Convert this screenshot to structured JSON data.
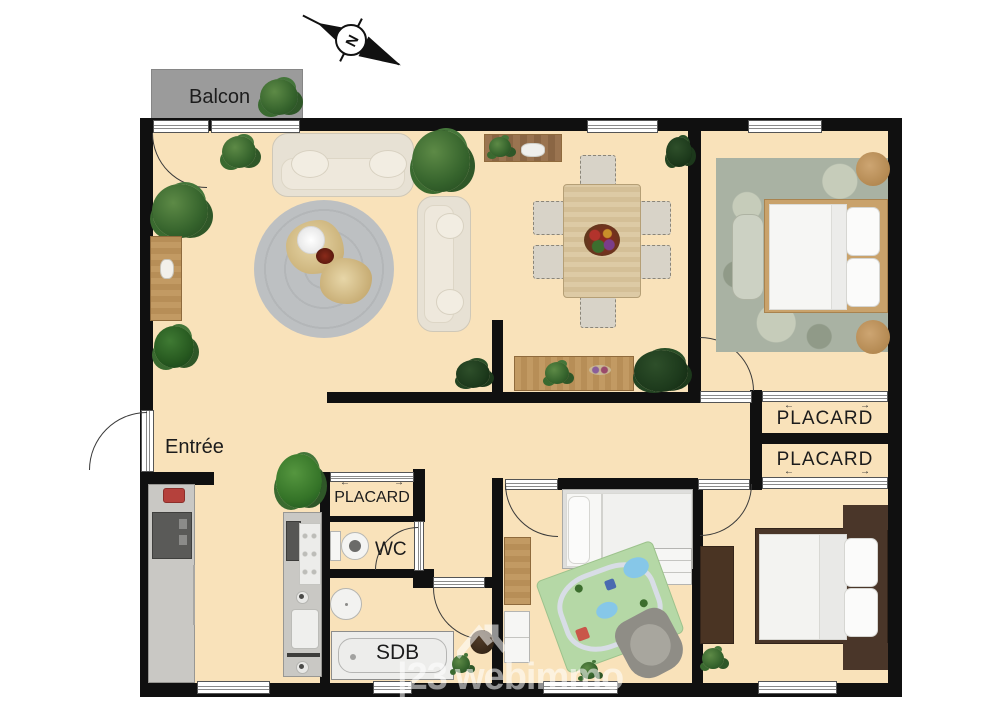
{
  "plan": {
    "compass": {
      "north_label": "N"
    },
    "balcony": {
      "label": "Balcon"
    },
    "rooms": {
      "entree": {
        "label": "Entrée"
      },
      "closet_hall": {
        "label": "PLACARD"
      },
      "wc": {
        "label": "WC"
      },
      "bathroom": {
        "label": "SDB"
      },
      "closet_1": {
        "label": "PLACARD"
      },
      "closet_2": {
        "label": "PLACARD"
      }
    },
    "ui": {
      "arrow_left": "←",
      "arrow_right": "→"
    },
    "watermark": {
      "prefix": "|23",
      "brand": "webimmo"
    },
    "colors": {
      "floor": "#f9e2ba",
      "wall": "#101010",
      "balcony_gray": "#9b9b9b"
    }
  }
}
